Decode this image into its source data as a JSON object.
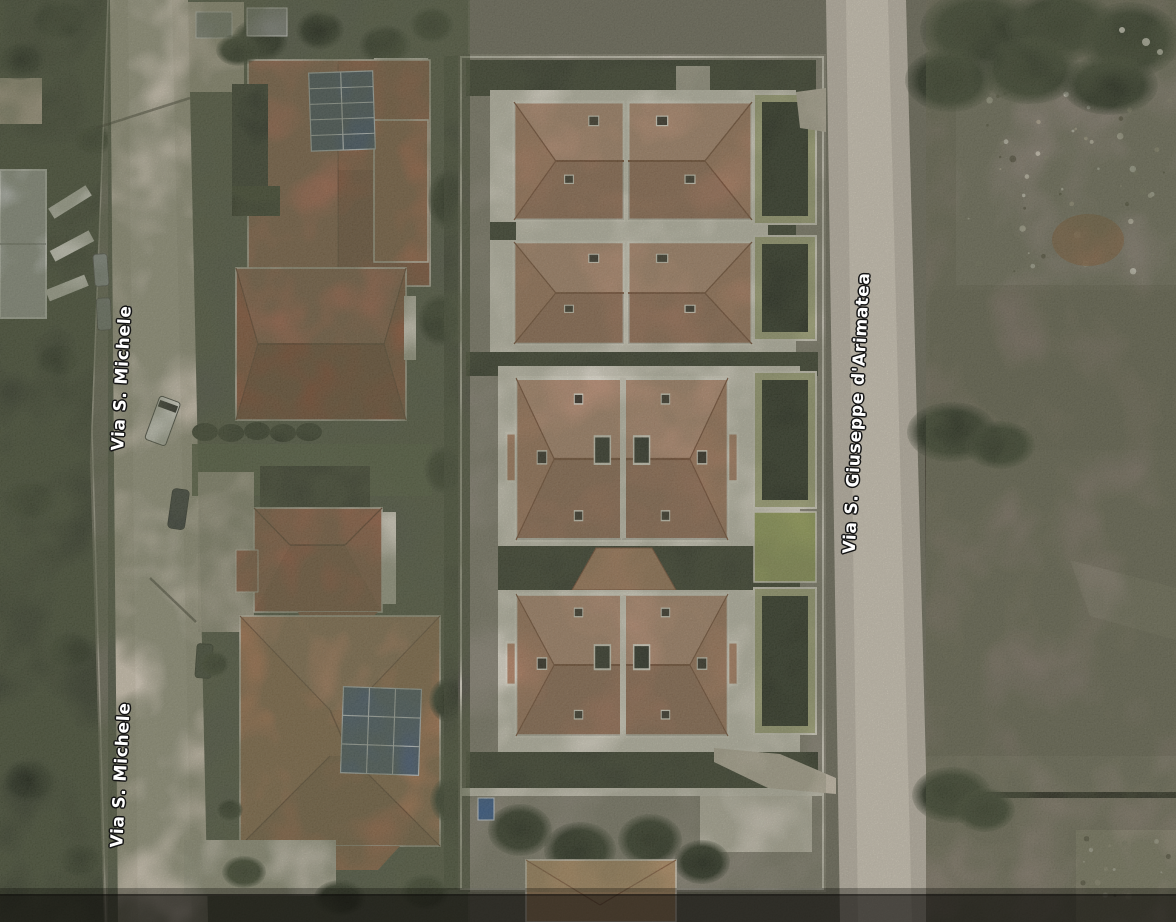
{
  "map": {
    "view_type": "satellite-aerial-imagery",
    "street_labels": [
      {
        "id": "via-s-michele-upper",
        "text": "Via S. Michele",
        "road": "left",
        "orientation": "vertical"
      },
      {
        "id": "via-s-michele-lower",
        "text": "Via S. Michele",
        "road": "left",
        "orientation": "vertical"
      },
      {
        "id": "via-s-giuseppe-darimatea",
        "text": "Via S. Giuseppe d'Arimatea",
        "road": "right",
        "orientation": "vertical"
      }
    ],
    "label_style": {
      "text_color": "#ffffff",
      "outline_color": "#141414"
    },
    "palette": {
      "road_left": "#cdc3b1",
      "road_right": "#b9b2a3",
      "roof_terracotta_complex": "#b8876a",
      "roof_terracotta_houses": "#9c6247",
      "roof_ridge": "#7d5038",
      "trim_white": "#ddd8ca",
      "vegetation_dark": "#3a3f2f",
      "vegetation_mid": "#575c49",
      "lawn_green": "#9aa35f",
      "field_scrub": "#7c7466",
      "rubble_gray": "#8b8375",
      "solar_panel_blue": "#46586e",
      "warehouse_gray": "#bcbeb9",
      "shadow_band": "#0b0a08"
    }
  }
}
